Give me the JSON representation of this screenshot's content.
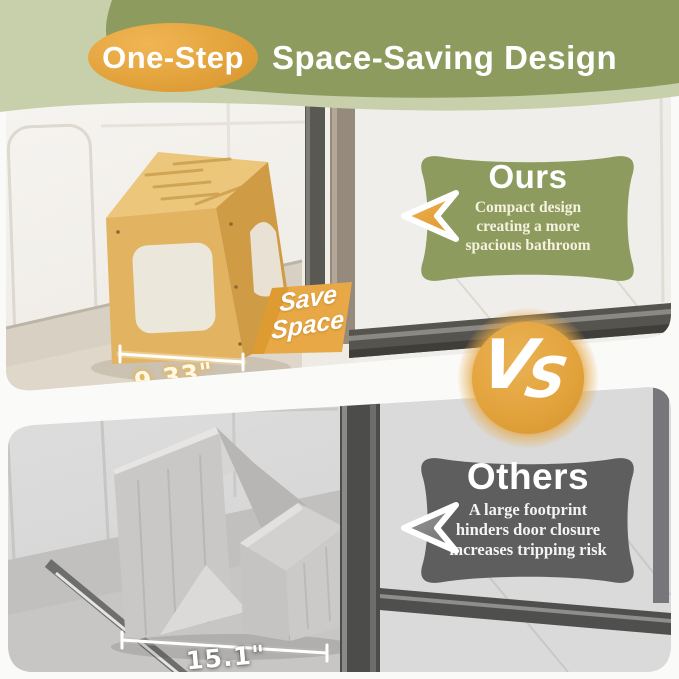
{
  "header": {
    "badge": "One-Step",
    "title": "Space-Saving Design"
  },
  "vs_label": "VS",
  "top_panel": {
    "label": "Ours",
    "description_lines": [
      "Compact design",
      "creating a more",
      "spacious bathroom"
    ],
    "ribbon_lines": [
      "Save",
      "Space"
    ],
    "measurement": "9.33\""
  },
  "bottom_panel": {
    "label": "Others",
    "description_lines": [
      "A large footprint",
      "hinders door closure",
      "increases tripping risk"
    ],
    "measurement": "15.1\""
  },
  "colors": {
    "olive": "#8d9b5e",
    "sage": "#c7d0aa",
    "orange": "#e3a23c",
    "dark_gray": "#5f5e5e",
    "bamboo": "#e2b360",
    "cream_text": "#f6f1df"
  }
}
